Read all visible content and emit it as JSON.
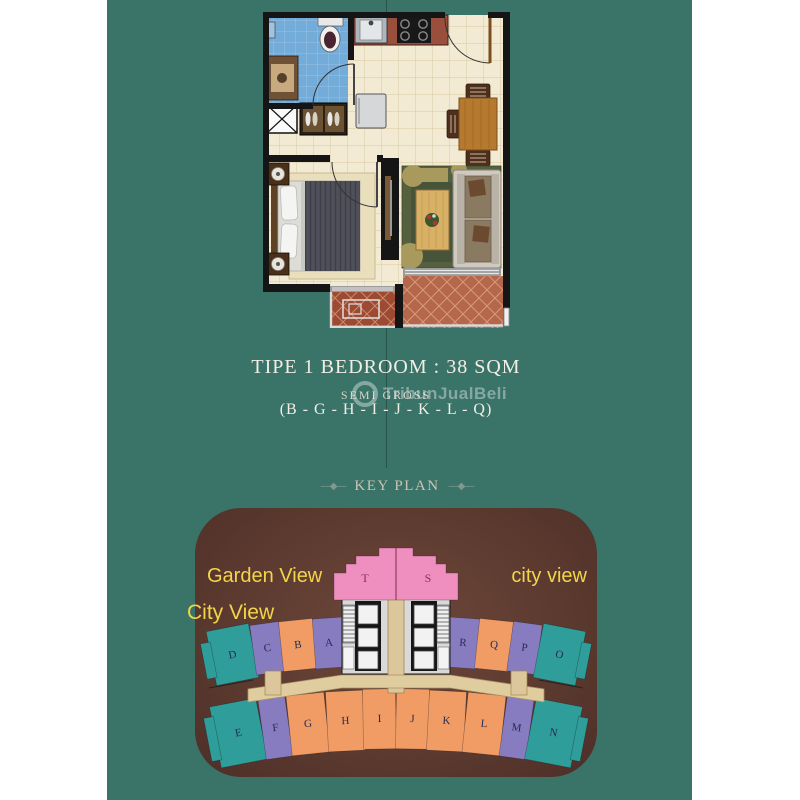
{
  "title": {
    "line1": "TIPE 1 BEDROOM : 38 SQM",
    "line2": "SEMI GROSS",
    "line3": "(B - G - H - I - J - K - L - Q)"
  },
  "watermark": {
    "text": "TribunJualBeli"
  },
  "keyplan": {
    "heading": "KEY PLAN",
    "ornament": "—◆—",
    "view_labels": {
      "garden": "Garden View",
      "city_left": "City View",
      "city_right": "city view"
    },
    "unit_labels": {
      "t": "T",
      "s": "S",
      "a": "A",
      "b": "B",
      "c": "C",
      "d": "D",
      "e": "E",
      "f": "F",
      "g": "G",
      "h": "H",
      "i": "I",
      "j": "J",
      "k": "K",
      "l": "L",
      "m": "M",
      "n": "N",
      "o": "O",
      "p": "P",
      "q": "Q",
      "r": "R"
    },
    "colors": {
      "pink": "#ef8fc0",
      "purple": "#877cc0",
      "orange": "#f09c64",
      "teal": "#2f9d99",
      "corridor": "#dfcd9f",
      "box_brown": "#5d3a2f",
      "label_yellow": "#f2d549",
      "canvas_teal": "#3a7368"
    }
  }
}
